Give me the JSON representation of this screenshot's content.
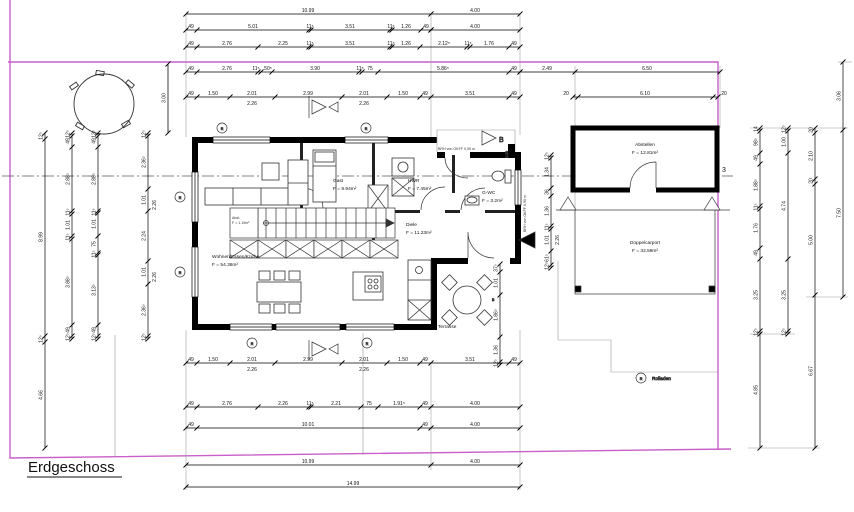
{
  "title": "Erdgeschoss",
  "boundary_color": "#c95fc9",
  "axis": {
    "label": "3"
  },
  "legend": {
    "symbol": "R",
    "label": "Rolladen"
  },
  "section": {
    "label": "B",
    "offset": "1.00"
  },
  "notes": {
    "brh": "BRH von OKFF 0,95 m"
  },
  "rooms": {
    "wohnen": {
      "label": "Wohnen/Essen/Küche",
      "area": "F = 54.36m²"
    },
    "gast": {
      "label": "Gast",
      "area": "F = 9.94m²"
    },
    "hwr": {
      "label": "HWR",
      "area": "F = 7.45m²"
    },
    "gwc": {
      "label": "G-WC",
      "area": "F = 3.2m²"
    },
    "diele": {
      "label": "Diele",
      "area": "F = 11.23m²"
    },
    "abstellen": {
      "label": "Abstellen",
      "area": "F = 12.81m²"
    },
    "carport": {
      "label": "Doppelcarport",
      "area": "F = 32.59m²"
    },
    "terrasse": {
      "label": "Terrasse",
      "area": ""
    },
    "abst": {
      "label": "Abst.",
      "area": "F = 1.19m²"
    }
  },
  "dimension_chains": [
    {
      "o": "h",
      "p": 14,
      "t": [
        186,
        431,
        520
      ],
      "l": [
        [
          308,
          "10.99"
        ],
        [
          475,
          "4.00"
        ]
      ]
    },
    {
      "o": "h",
      "p": 30,
      "t": [
        186,
        197,
        309,
        311,
        390,
        392,
        421,
        431
      ],
      "l": [
        [
          191,
          "49"
        ],
        [
          253,
          "5.01"
        ],
        [
          310,
          "11⁵"
        ],
        [
          350,
          "3.51"
        ],
        [
          391,
          "11⁵"
        ],
        [
          406,
          "1.26"
        ],
        [
          426,
          "49"
        ]
      ]
    },
    {
      "o": "h",
      "p": 30,
      "t": [
        431,
        520
      ],
      "l": [
        [
          475,
          "4.00"
        ]
      ]
    },
    {
      "o": "h",
      "p": 47,
      "t": [
        186,
        197,
        258,
        309,
        311,
        390,
        392,
        420,
        467,
        470,
        509,
        520
      ],
      "l": [
        [
          191,
          "49"
        ],
        [
          227,
          "2.76"
        ],
        [
          283,
          "2.25"
        ],
        [
          310,
          "11⁵"
        ],
        [
          350,
          "3.51"
        ],
        [
          391,
          "11⁵"
        ],
        [
          406,
          "1.26"
        ],
        [
          444,
          "2.12⁵"
        ],
        [
          468,
          "11⁵"
        ],
        [
          489,
          "1.76"
        ],
        [
          514,
          "49"
        ]
      ]
    },
    {
      "o": "h",
      "p": 72,
      "t": [
        186,
        197,
        258,
        261,
        272,
        359,
        362,
        378,
        509,
        520
      ],
      "l": [
        [
          191,
          "49"
        ],
        [
          227,
          "2.76"
        ],
        [
          256,
          "11⁵"
        ],
        [
          268,
          "50⁵"
        ],
        [
          315,
          "3.90"
        ],
        [
          360,
          "11⁵"
        ],
        [
          370,
          "75"
        ],
        [
          443,
          "5.86⁵"
        ],
        [
          514,
          "49"
        ]
      ]
    },
    {
      "o": "h",
      "p": 72,
      "t": [
        520,
        575,
        720
      ],
      "l": [
        [
          547,
          "2.49"
        ],
        [
          647,
          "6.50"
        ]
      ]
    },
    {
      "o": "h",
      "p": 97,
      "t": [
        186,
        197,
        230,
        275,
        342,
        387,
        420,
        431,
        509,
        520
      ],
      "l": [
        [
          191,
          "49"
        ],
        [
          213,
          "1.50"
        ],
        [
          252,
          "2.01"
        ],
        [
          308,
          "2.99"
        ],
        [
          364,
          "2.01"
        ],
        [
          403,
          "1.50"
        ],
        [
          425,
          "49"
        ],
        [
          470,
          "3.51"
        ],
        [
          514,
          "49"
        ]
      ],
      "s": [
        [
          252,
          "2.26"
        ],
        [
          364,
          "2.26"
        ]
      ]
    },
    {
      "o": "h",
      "p": 97,
      "t": [
        573,
        578,
        713,
        718
      ],
      "l": [
        [
          566,
          "20"
        ],
        [
          645,
          "6.10"
        ],
        [
          724,
          "20"
        ]
      ]
    },
    {
      "o": "h",
      "p": 363,
      "t": [
        186,
        197,
        230,
        275,
        342,
        387,
        420,
        431,
        509,
        520
      ],
      "l": [
        [
          191,
          "49"
        ],
        [
          213,
          "1.50"
        ],
        [
          252,
          "2.01"
        ],
        [
          308,
          "2.99"
        ],
        [
          364,
          "2.01"
        ],
        [
          403,
          "1.50"
        ],
        [
          425,
          "49"
        ],
        [
          470,
          "3.51"
        ],
        [
          514,
          "49"
        ]
      ],
      "s": [
        [
          252,
          "2.26"
        ],
        [
          364,
          "2.26"
        ]
      ]
    },
    {
      "o": "h",
      "p": 407,
      "t": [
        186,
        197,
        258,
        309,
        311,
        361,
        378,
        420,
        431,
        520
      ],
      "l": [
        [
          191,
          "49"
        ],
        [
          227,
          "2.76"
        ],
        [
          283,
          "2.26"
        ],
        [
          310,
          "11⁵"
        ],
        [
          336,
          "2.21"
        ],
        [
          369,
          "75"
        ],
        [
          399,
          "1.91⁵"
        ],
        [
          425,
          "49"
        ],
        [
          475,
          "4.00"
        ]
      ]
    },
    {
      "o": "h",
      "p": 428,
      "t": [
        186,
        197,
        420,
        431,
        520
      ],
      "l": [
        [
          191,
          "49"
        ],
        [
          308,
          "10.01"
        ],
        [
          425,
          "49"
        ],
        [
          475,
          "4.00"
        ]
      ]
    },
    {
      "o": "h",
      "p": 465,
      "t": [
        186,
        431,
        520
      ],
      "l": [
        [
          308,
          "10.99"
        ],
        [
          475,
          "4.00"
        ]
      ]
    },
    {
      "o": "h",
      "p": 487,
      "t": [
        186,
        520
      ],
      "l": [
        [
          353,
          "14.99"
        ]
      ]
    },
    {
      "o": "v",
      "p": 45,
      "t": [
        133,
        139,
        336,
        342,
        448
      ],
      "l": [
        [
          136,
          "12⁵"
        ],
        [
          237,
          "8.99"
        ],
        [
          339,
          "12⁵"
        ],
        [
          395,
          "4.66"
        ]
      ]
    },
    {
      "o": "v",
      "p": 72,
      "t": [
        133,
        136,
        147,
        211,
        214,
        236,
        239,
        325,
        336,
        339
      ],
      "l": [
        [
          134,
          "12⁵"
        ],
        [
          141,
          "49"
        ],
        [
          179,
          "2.88⁵"
        ],
        [
          212,
          "11⁵"
        ],
        [
          225,
          "1.01"
        ],
        [
          237,
          "11⁵"
        ],
        [
          282,
          "3.88⁵"
        ],
        [
          330,
          "49"
        ],
        [
          337,
          "12⁵"
        ]
      ]
    },
    {
      "o": "v",
      "p": 98,
      "t": [
        133,
        136,
        147,
        211,
        213,
        236,
        253,
        255,
        325,
        336,
        339
      ],
      "l": [
        [
          134,
          "12⁵"
        ],
        [
          141,
          "49"
        ],
        [
          179,
          "2.88⁵"
        ],
        [
          212,
          "11⁵"
        ],
        [
          224,
          "1.01"
        ],
        [
          244,
          "75"
        ],
        [
          254,
          "11⁵"
        ],
        [
          290,
          "3.13⁵"
        ],
        [
          330,
          "49"
        ],
        [
          337,
          "12⁵"
        ]
      ]
    },
    {
      "o": "v",
      "p": 148,
      "t": [
        133,
        136,
        189,
        211,
        261,
        284,
        336,
        339
      ],
      "l": [
        [
          134,
          "12⁵"
        ],
        [
          162,
          "2.36⁵"
        ],
        [
          200,
          "1.01"
        ],
        [
          236,
          "2.24"
        ],
        [
          272,
          "1.01"
        ],
        [
          310,
          "2.36⁵"
        ],
        [
          337,
          "12⁵"
        ]
      ],
      "s": [
        [
          205,
          "2.26"
        ],
        [
          277,
          "2.26"
        ]
      ]
    },
    {
      "o": "v",
      "p": 168,
      "t": [
        64,
        133
      ],
      "l": [
        [
          98,
          "3.00"
        ]
      ]
    },
    {
      "o": "v",
      "p": 551,
      "t": [
        155,
        158,
        188,
        196,
        226,
        229,
        251,
        265,
        268
      ],
      "l": [
        [
          156,
          "12⁵"
        ],
        [
          172,
          "1.34"
        ],
        [
          192,
          "36"
        ],
        [
          211,
          "1.36"
        ],
        [
          227,
          "11⁵"
        ],
        [
          240,
          "1.01"
        ],
        [
          258,
          "61⁵"
        ],
        [
          266,
          "12⁵"
        ]
      ],
      "s": [
        [
          240,
          "2.26"
        ]
      ]
    },
    {
      "o": "v",
      "p": 500,
      "t": [
        264,
        272,
        295,
        337,
        362,
        365
      ],
      "l": [
        [
          268,
          "37⁵"
        ],
        [
          283,
          "1.01"
        ],
        [
          315,
          "1.86⁵"
        ],
        [
          350,
          "1.36"
        ],
        [
          363,
          "12⁵"
        ]
      ]
    },
    {
      "o": "v",
      "p": 760,
      "t": [
        128,
        131,
        153,
        164,
        206,
        209,
        248,
        259,
        331,
        334,
        448
      ],
      "l": [
        [
          129,
          "14"
        ],
        [
          142,
          "98⁵"
        ],
        [
          158,
          "49"
        ],
        [
          185,
          "1.88⁵"
        ],
        [
          207,
          "11⁵"
        ],
        [
          228,
          "1.76"
        ],
        [
          253,
          "49"
        ],
        [
          295,
          "3.25"
        ],
        [
          332,
          "12⁵"
        ],
        [
          390,
          "4.85"
        ]
      ]
    },
    {
      "o": "v",
      "p": 788,
      "t": [
        128,
        131,
        153,
        259,
        331,
        334
      ],
      "l": [
        [
          129,
          "12⁵"
        ],
        [
          142,
          "1.00"
        ],
        [
          206,
          "4.74"
        ],
        [
          295,
          "3.25"
        ],
        [
          332,
          "12⁵"
        ]
      ]
    },
    {
      "o": "v",
      "p": 815,
      "t": [
        128,
        133,
        179,
        184,
        295,
        448
      ],
      "l": [
        [
          130,
          "20"
        ],
        [
          156,
          "2.10"
        ],
        [
          181,
          "20"
        ],
        [
          240,
          "5.00"
        ],
        [
          371,
          "6.67"
        ]
      ]
    },
    {
      "o": "v",
      "p": 843,
      "t": [
        62,
        130,
        297
      ],
      "l": [
        [
          96,
          "3.06"
        ],
        [
          213,
          "7.50"
        ]
      ]
    }
  ]
}
